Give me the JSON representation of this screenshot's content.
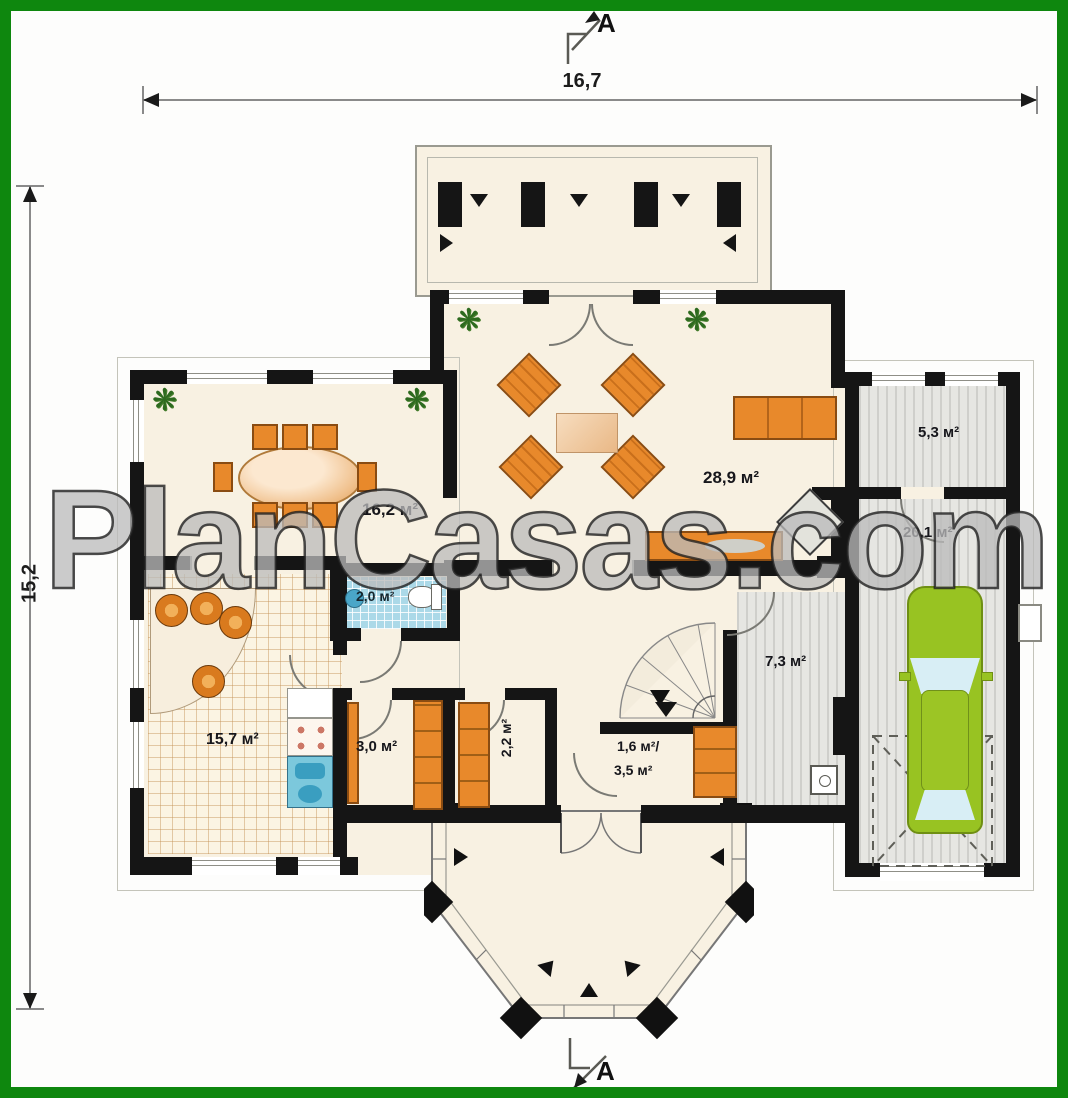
{
  "watermark": "PlanCasas.com",
  "dimensions": {
    "top": "16,7",
    "left": "15,2"
  },
  "section": {
    "top": "A",
    "bottom": "A"
  },
  "rooms": {
    "dining": "16,2 м²",
    "living": "28,9 м²",
    "kitchen": "15,7 м²",
    "wc": "2,0 м²",
    "pantry": "3,0 м²",
    "closet": "2,2 м²",
    "stair_line1": "1,6 м²/",
    "stair_line2": "3,5 м²",
    "corridor": "7,3 м²",
    "storage": "5,3 м²",
    "garage": "20,1 м²"
  },
  "colors": {
    "frame": "#0e870e",
    "walls": "#151515",
    "floor": "#f8f1e2",
    "furniture": "#e8892b",
    "car": "#98c322",
    "tile": "#abd9e8"
  }
}
